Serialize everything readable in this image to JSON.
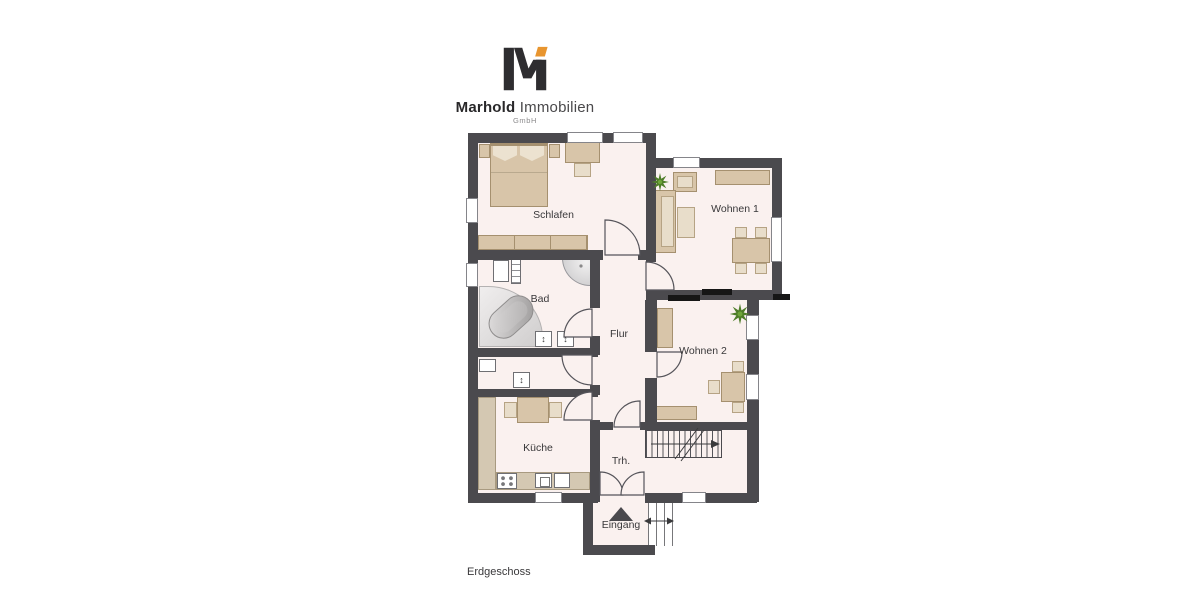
{
  "brand": {
    "logo_text_bold": "Marhold",
    "logo_text_light": "Immobilien",
    "logo_suffix": "GmbH"
  },
  "plan": {
    "floor_label": "Erdgeschoss",
    "rooms": [
      {
        "label": "Schlafen"
      },
      {
        "label": "Wohnen 1"
      },
      {
        "label": "Bad"
      },
      {
        "label": "Flur"
      },
      {
        "label": "Wohnen 2"
      },
      {
        "label": "Küche"
      },
      {
        "label": "Trh."
      },
      {
        "label": "Eingang"
      }
    ]
  },
  "icons": {
    "basin_arrow": "↕"
  },
  "colors": {
    "wall": "#4b4a4e",
    "accent_wall": "#161616",
    "floor": "#faf1ef",
    "furniture": "#d8c5a9",
    "logo_accent": "#e8952f",
    "plant": "#4e7d28"
  }
}
